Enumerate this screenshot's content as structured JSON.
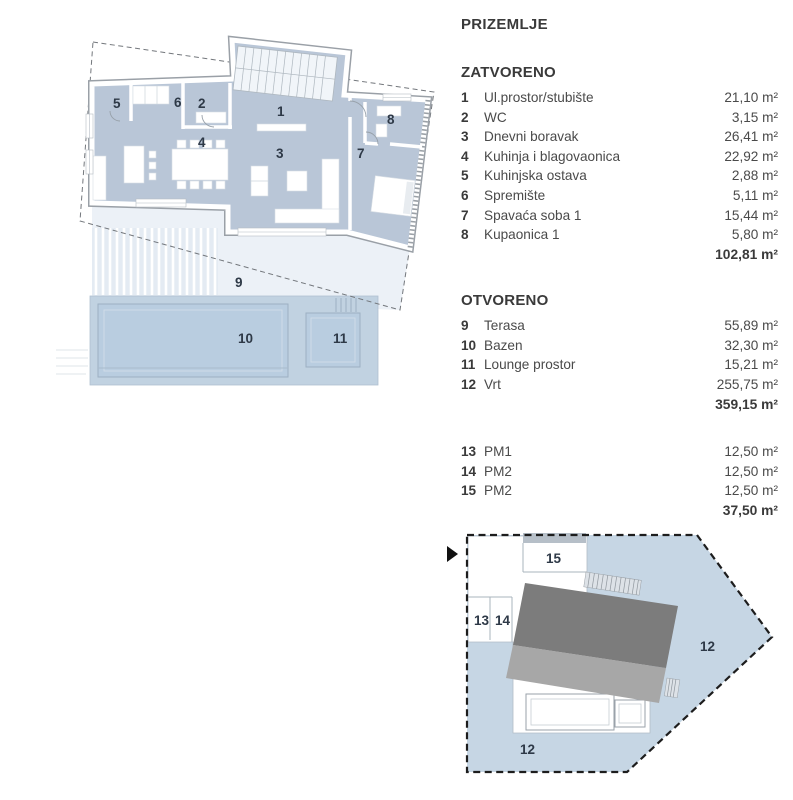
{
  "legend": {
    "title": "PRIZEMLJE",
    "sections": [
      {
        "heading": "ZATVORENO",
        "items": [
          {
            "num": "1",
            "name": "Ul.prostor/stubište",
            "area": "21,10 m²"
          },
          {
            "num": "2",
            "name": "WC",
            "area": "3,15 m²"
          },
          {
            "num": "3",
            "name": "Dnevni boravak",
            "area": "26,41 m²"
          },
          {
            "num": "4",
            "name": "Kuhinja i blagovaonica",
            "area": "22,92 m²"
          },
          {
            "num": "5",
            "name": "Kuhinjska ostava",
            "area": "2,88 m²"
          },
          {
            "num": "6",
            "name": "Spremište",
            "area": "5,11 m²"
          },
          {
            "num": "7",
            "name": "Spavaća soba 1",
            "area": "15,44 m²"
          },
          {
            "num": "8",
            "name": "Kupaonica 1",
            "area": "5,80 m²"
          }
        ],
        "total": "102,81 m²"
      },
      {
        "heading": "OTVORENO",
        "items": [
          {
            "num": "9",
            "name": "Terasa",
            "area": "55,89 m²"
          },
          {
            "num": "10",
            "name": "Bazen",
            "area": "32,30 m²"
          },
          {
            "num": "11",
            "name": "Lounge prostor",
            "area": "15,21 m²"
          },
          {
            "num": "12",
            "name": "Vrt",
            "area": "255,75 m²"
          }
        ],
        "total": "359,15 m²"
      },
      {
        "heading": "",
        "items": [
          {
            "num": "13",
            "name": "PM1",
            "area": "12,50 m²"
          },
          {
            "num": "14",
            "name": "PM2",
            "area": "12,50 m²"
          },
          {
            "num": "15",
            "name": "PM2",
            "area": "12,50 m²"
          }
        ],
        "total": "37,50 m²"
      }
    ]
  },
  "floor_plan": {
    "room_labels": [
      {
        "num": "1",
        "x": 277,
        "y": 116
      },
      {
        "num": "2",
        "x": 198,
        "y": 108
      },
      {
        "num": "3",
        "x": 276,
        "y": 158
      },
      {
        "num": "4",
        "x": 198,
        "y": 147
      },
      {
        "num": "5",
        "x": 113,
        "y": 108
      },
      {
        "num": "6",
        "x": 174,
        "y": 107
      },
      {
        "num": "7",
        "x": 357,
        "y": 158
      },
      {
        "num": "8",
        "x": 387,
        "y": 124
      },
      {
        "num": "9",
        "x": 235,
        "y": 287
      },
      {
        "num": "10",
        "x": 238,
        "y": 343
      },
      {
        "num": "11",
        "x": 333,
        "y": 343
      }
    ]
  },
  "site_plan": {
    "labels": [
      {
        "num": "12",
        "x": 700,
        "y": 651
      },
      {
        "num": "12",
        "x": 520,
        "y": 754
      },
      {
        "num": "13",
        "x": 474,
        "y": 625
      },
      {
        "num": "14",
        "x": 495,
        "y": 625
      },
      {
        "num": "15",
        "x": 546,
        "y": 563
      }
    ]
  },
  "colors": {
    "room_fill": "#b9c6d7",
    "terrace_fill": "#ecf1f7",
    "pool_fill": "#b9cde0",
    "pool_zone": "#c1d2e1",
    "garden_fill": "#c6d6e4",
    "roof_dark": "#7c7c7c",
    "roof_light": "#a7a7a7",
    "wall_line": "#9aa0a7",
    "boundary_line": "#73777c",
    "text": "#3a3a3a",
    "plan_label": "#2e3947"
  }
}
